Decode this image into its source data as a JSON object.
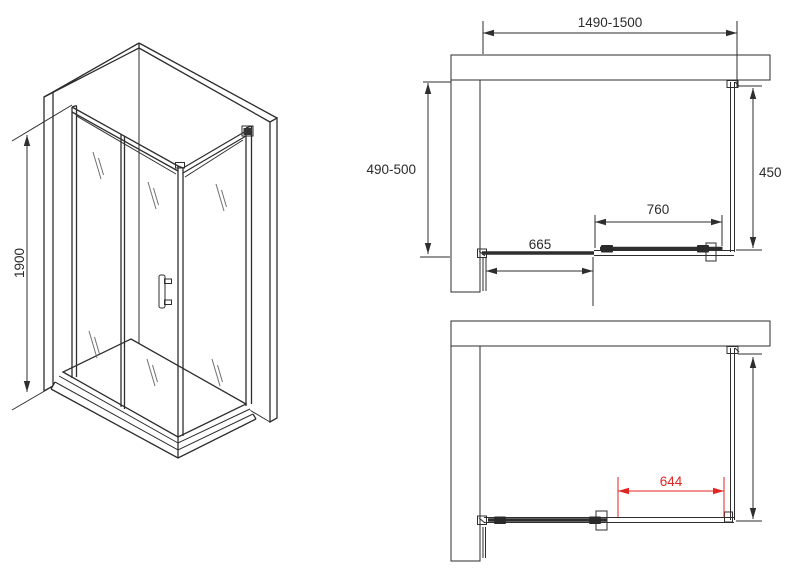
{
  "isometric_view": {
    "height_dimension": "1900"
  },
  "top_plan": {
    "overall_width": "1490-1500",
    "wall_depth": "490-500",
    "side_panel_depth": "450",
    "door_width": "760",
    "fixed_panel_width": "665"
  },
  "bottom_plan": {
    "door_opening_width": "644"
  },
  "colors": {
    "line": "#2e2e2e",
    "dimension_red": "#e02522"
  }
}
